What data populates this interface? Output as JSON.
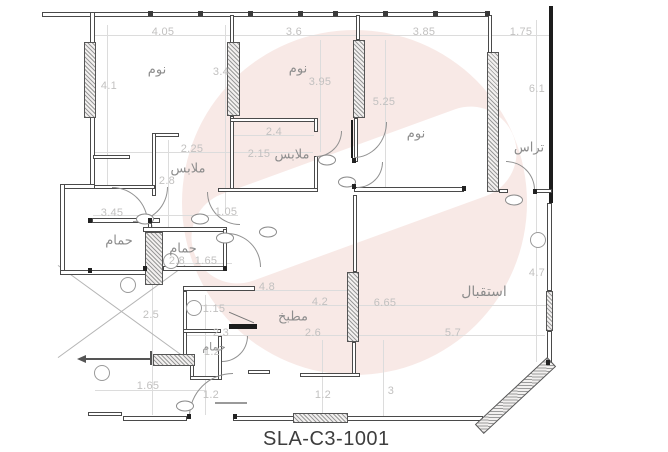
{
  "title": "SLA-C3-1001",
  "colors": {
    "wall_line": "#4a4a4a",
    "outer_wall": "#1c1c1c",
    "dim_text": "#c2c1c0",
    "room_text": "#8d8d8d",
    "watermark_pink": "#f8e9e6",
    "title_text": "#3d3d3d"
  },
  "rooms": [
    {
      "label": "نوم",
      "x": 157,
      "y": 70
    },
    {
      "label": "نوم",
      "x": 298,
      "y": 69
    },
    {
      "label": "نوم",
      "x": 416,
      "y": 134
    },
    {
      "label": "تراس",
      "x": 529,
      "y": 148
    },
    {
      "label": "ملابس",
      "x": 188,
      "y": 169
    },
    {
      "label": "ملابس",
      "x": 292,
      "y": 155
    },
    {
      "label": "حمام",
      "x": 119,
      "y": 241
    },
    {
      "label": "حمام",
      "x": 183,
      "y": 249
    },
    {
      "label": "حمام",
      "x": 214,
      "y": 347,
      "s": 11
    },
    {
      "label": "مطبخ",
      "x": 293,
      "y": 317
    },
    {
      "label": "استقبال",
      "x": 484,
      "y": 292,
      "s": 14
    }
  ],
  "dimensions": [
    {
      "v": "4.05",
      "x": 163,
      "y": 32
    },
    {
      "v": "3.6",
      "x": 294,
      "y": 32
    },
    {
      "v": "3.85",
      "x": 424,
      "y": 32
    },
    {
      "v": "1.75",
      "x": 521,
      "y": 32
    },
    {
      "v": "4.1",
      "x": 109,
      "y": 86
    },
    {
      "v": "3.4",
      "x": 221,
      "y": 72
    },
    {
      "v": "3.95",
      "x": 320,
      "y": 82
    },
    {
      "v": "5.25",
      "x": 384,
      "y": 102
    },
    {
      "v": "6.1",
      "x": 537,
      "y": 89
    },
    {
      "v": "2.4",
      "x": 274,
      "y": 132
    },
    {
      "v": "2.25",
      "x": 192,
      "y": 149
    },
    {
      "v": "2.15",
      "x": 259,
      "y": 154
    },
    {
      "v": "2.8",
      "x": 167,
      "y": 181
    },
    {
      "v": "1.05",
      "x": 226,
      "y": 212
    },
    {
      "v": "3.45",
      "x": 112,
      "y": 213
    },
    {
      "v": "2.8",
      "x": 177,
      "y": 261
    },
    {
      "v": "1.65",
      "x": 206,
      "y": 261
    },
    {
      "v": "2.5",
      "x": 151,
      "y": 315
    },
    {
      "v": "1.15",
      "x": 214,
      "y": 309
    },
    {
      "v": "4.8",
      "x": 267,
      "y": 287
    },
    {
      "v": "4.2",
      "x": 320,
      "y": 302
    },
    {
      "v": "6.65",
      "x": 385,
      "y": 303
    },
    {
      "v": "2.3",
      "x": 221,
      "y": 333
    },
    {
      "v": "2.6",
      "x": 313,
      "y": 333
    },
    {
      "v": "5.7",
      "x": 453,
      "y": 333
    },
    {
      "v": "4.7",
      "x": 537,
      "y": 273
    },
    {
      "v": "1.2",
      "x": 212,
      "y": 352
    },
    {
      "v": "1.65",
      "x": 148,
      "y": 386
    },
    {
      "v": "1.2",
      "x": 211,
      "y": 395
    },
    {
      "v": "1.2",
      "x": 323,
      "y": 395
    },
    {
      "v": "3",
      "x": 391,
      "y": 391
    }
  ]
}
